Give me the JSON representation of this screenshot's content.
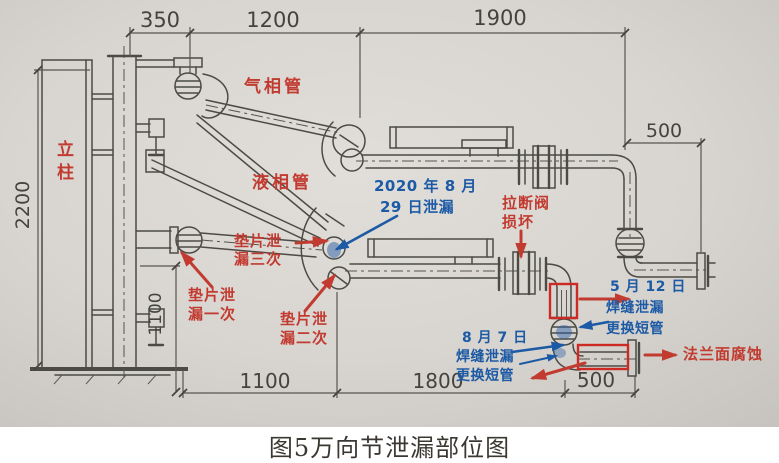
{
  "caption": "图5万向节泄漏部位图",
  "colors": {
    "annotation_red": "#c23b31",
    "annotation_blue": "#1d5aa5",
    "highlight_box_red": "#cc2a22",
    "drawing_line": "#4b4a44",
    "paper_background": "#d8d5d0"
  },
  "labels": {
    "column": "立柱",
    "gas_pipe": "气相管",
    "liquid_pipe": "液相管"
  },
  "red_notes": {
    "gasket_leak_once": [
      "垫片泄",
      "漏一次"
    ],
    "gasket_leak_twice": [
      "垫片泄",
      "漏二次"
    ],
    "gasket_leak_thrice": [
      "垫片泄",
      "漏三次"
    ],
    "breakaway_valve_damaged": [
      "拉断阀",
      "损坏"
    ],
    "flange_face_corrosion": "法兰面腐蚀"
  },
  "blue_notes": {
    "leak_2020_08_29": [
      "2020 年 8 月",
      "29 日泄漏"
    ],
    "may_12": [
      "5 月 12 日",
      "焊缝泄漏",
      "更换短管"
    ],
    "aug_7": [
      "8 月 7 日",
      "焊缝泄漏",
      "更换短管"
    ]
  },
  "dimensions": {
    "top_350": "350",
    "top_1200": "1200",
    "top_1900": "1900",
    "right_500": "500",
    "left_2200": "2200",
    "inner_1100": "1100",
    "bottom_1100": "1100",
    "bottom_1800": "1800",
    "bottom_500": "500"
  }
}
